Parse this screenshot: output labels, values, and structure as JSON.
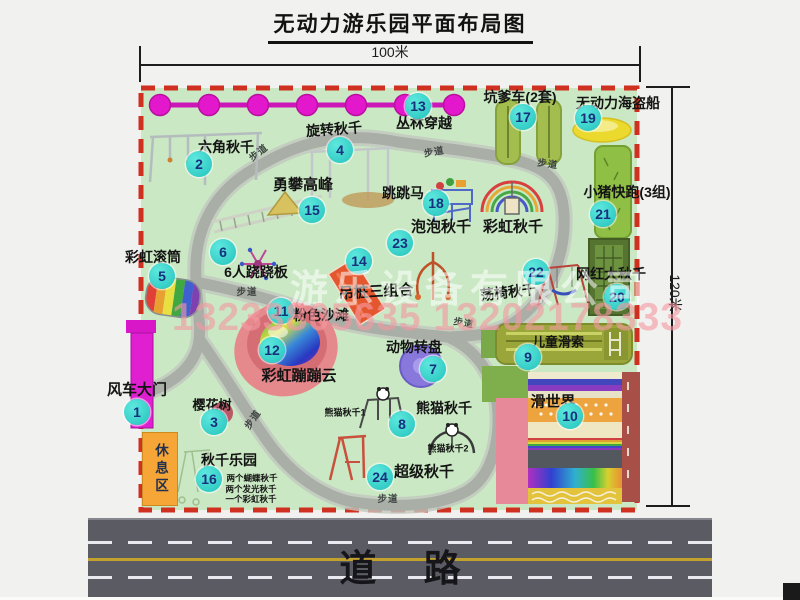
{
  "title": "无动力游乐园平面布局图",
  "dimensions": {
    "top": "100米",
    "right": "120米"
  },
  "road": {
    "label": "道 路"
  },
  "watermark": {
    "line1": "游乐设备有限公司",
    "line2": "13233805635 13202178333"
  },
  "rest_area": {
    "label": "休息区"
  },
  "trails": {
    "label": "步道",
    "positions": [
      {
        "x": 258,
        "y": 152,
        "r": -38
      },
      {
        "x": 434,
        "y": 151,
        "r": -10
      },
      {
        "x": 548,
        "y": 163,
        "r": 8
      },
      {
        "x": 247,
        "y": 291,
        "r": 0
      },
      {
        "x": 252,
        "y": 419,
        "r": -55
      },
      {
        "x": 464,
        "y": 322,
        "r": 10
      },
      {
        "x": 388,
        "y": 498,
        "r": 0
      }
    ]
  },
  "attractions": [
    {
      "num": 1,
      "name": "风车大门",
      "bx": 137,
      "by": 412,
      "lx": 137,
      "ly": 389,
      "ls": 15
    },
    {
      "num": 2,
      "name": "六角秋千",
      "bx": 199,
      "by": 164,
      "lx": 226,
      "ly": 147,
      "ls": 14
    },
    {
      "num": 3,
      "name": "樱花树",
      "bx": 214,
      "by": 422,
      "lx": 212,
      "ly": 404,
      "ls": 13
    },
    {
      "num": 4,
      "name": "旋转秋千",
      "bx": 340,
      "by": 150,
      "lx": 334,
      "ly": 129,
      "ls": 14,
      "lr": -4
    },
    {
      "num": 5,
      "name": "彩虹滚筒",
      "bx": 162,
      "by": 276,
      "lx": 153,
      "ly": 257,
      "ls": 14
    },
    {
      "num": 6,
      "name": "6人跷跷板",
      "bx": 223,
      "by": 252,
      "lx": 256,
      "ly": 272,
      "ls": 14
    },
    {
      "num": 7,
      "name": "动物转盘",
      "bx": 433,
      "by": 369,
      "lx": 414,
      "ly": 347,
      "ls": 14
    },
    {
      "num": 8,
      "name": "熊猫秋千",
      "bx": 402,
      "by": 424,
      "lx": 444,
      "ly": 408,
      "ls": 14
    },
    {
      "num": 9,
      "name": "儿童滑索",
      "bx": 528,
      "by": 357,
      "lx": 558,
      "ly": 341,
      "ls": 13
    },
    {
      "num": 10,
      "name": "滑世界",
      "bx": 570,
      "by": 416,
      "lx": 553,
      "ly": 401,
      "ls": 15
    },
    {
      "num": 11,
      "name": "粉色沙滩",
      "bx": 281,
      "by": 311,
      "lx": 321,
      "ly": 315,
      "ls": 14
    },
    {
      "num": 12,
      "name": "彩虹蹦蹦云",
      "bx": 272,
      "by": 350,
      "lx": 299,
      "ly": 375,
      "ls": 15
    },
    {
      "num": 13,
      "name": "丛林穿越",
      "bx": 418,
      "by": 106,
      "lx": 424,
      "ly": 123,
      "ls": 14
    },
    {
      "num": 14,
      "name": "吊桩三组合",
      "bx": 359,
      "by": 261,
      "lx": 376,
      "ly": 291,
      "ls": 15,
      "lr": -3
    },
    {
      "num": 15,
      "name": "勇攀高峰",
      "bx": 312,
      "by": 210,
      "lx": 303,
      "ly": 184,
      "ls": 15
    },
    {
      "num": 16,
      "name": "秋千乐园",
      "bx": 209,
      "by": 479,
      "lx": 229,
      "ly": 460,
      "ls": 14
    },
    {
      "num": 17,
      "name": "坑爹车(2套)",
      "bx": 523,
      "by": 117,
      "lx": 520,
      "ly": 97,
      "ls": 14
    },
    {
      "num": 18,
      "name": "跳跳马",
      "bx": 436,
      "by": 203,
      "lx": 403,
      "ly": 193,
      "ls": 14
    },
    {
      "num": 19,
      "name": "无动力海盗船",
      "bx": 588,
      "by": 118,
      "lx": 618,
      "ly": 103,
      "ls": 14
    },
    {
      "num": 20,
      "name": "网红大秋千",
      "bx": 617,
      "by": 297,
      "lx": 611,
      "ly": 274,
      "ls": 14
    },
    {
      "num": 21,
      "name": "小猪快跑(3组)",
      "bx": 603,
      "by": 214,
      "lx": 627,
      "ly": 192,
      "ls": 14
    },
    {
      "num": 22,
      "name": "荡椅秋千",
      "bx": 536,
      "by": 272,
      "lx": 508,
      "ly": 292,
      "ls": 14,
      "lr": -7
    },
    {
      "num": 23,
      "name": "泡泡秋千",
      "bx": 400,
      "by": 243,
      "lx": 441,
      "ly": 226,
      "ls": 15
    },
    {
      "num": 24,
      "name": "超级秋千",
      "bx": 380,
      "by": 477,
      "lx": 424,
      "ly": 471,
      "ls": 15
    }
  ],
  "extra_labels": [
    {
      "text": "彩虹秋千",
      "x": 513,
      "y": 226,
      "s": 15
    },
    {
      "text": "熊猫秋千1",
      "x": 345,
      "y": 412,
      "s": 9
    },
    {
      "text": "熊猫秋千2",
      "x": 448,
      "y": 448,
      "s": 9
    },
    {
      "text": "两个蝴蝶秋千",
      "x": 252,
      "y": 478,
      "s": 8.5
    },
    {
      "text": "两个发光秋千",
      "x": 251,
      "y": 489,
      "s": 8.5
    },
    {
      "text": "一个彩虹秋千",
      "x": 251,
      "y": 499,
      "s": 8.5
    }
  ],
  "colors": {
    "park_fill": "#c9e8c3",
    "boundary_red": "#d03020",
    "path_gray": "#a9aea7",
    "badge_teal": "#23c3bd",
    "badge_text": "#17317d",
    "zipline_magenta": "#e318cc",
    "road_gray": "#5b5b63",
    "rest_area_orange": "#f5a636"
  }
}
